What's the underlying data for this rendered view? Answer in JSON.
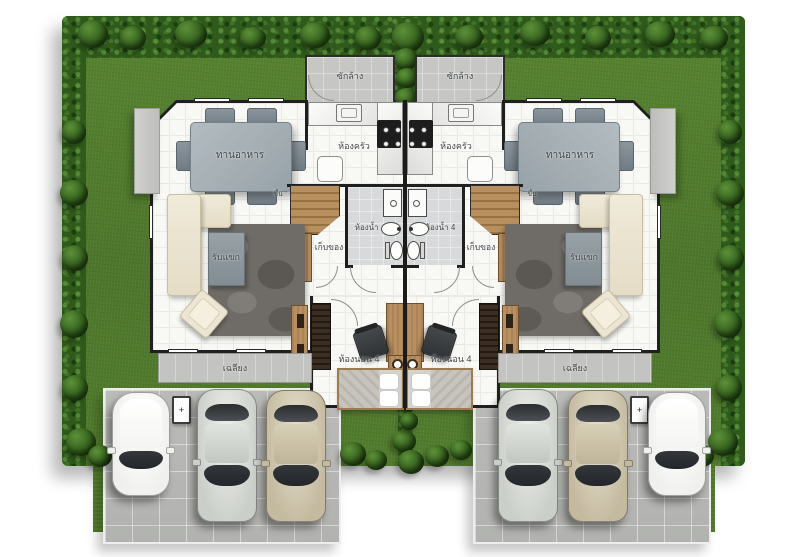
{
  "title": "Duplex twin-house floor plan, top view",
  "labels": {
    "laundry": "ซักล้าง",
    "kitchen": "ห้องครัว",
    "dining": "ทานอาหาร",
    "living": "รับแขก",
    "bathroom": "ห้องน้ำ 4",
    "storage": "เก็บของ",
    "bedroom": "ห้องนอน 4",
    "terrace": "เฉลียง",
    "stairs": "ขึ้น",
    "meter": "+"
  },
  "units": [
    {
      "side": "left"
    },
    {
      "side": "right",
      "note": "mirror image of left unit"
    }
  ],
  "cars": [
    {
      "position": "left-outer",
      "color_name": "white",
      "body_color": "#f0f0ee",
      "type": "compact"
    },
    {
      "position": "left-middle",
      "color_name": "silver",
      "body_color": "#cbcfc9",
      "type": "sedan"
    },
    {
      "position": "left-inner",
      "color_name": "beige",
      "body_color": "#c4baa0",
      "type": "sedan"
    },
    {
      "position": "right-inner",
      "color_name": "silver",
      "body_color": "#cbcfc9",
      "type": "sedan"
    },
    {
      "position": "right-middle",
      "color_name": "beige",
      "body_color": "#c4baa0",
      "type": "sedan"
    },
    {
      "position": "right-outer",
      "color_name": "white",
      "body_color": "#f0f0ee",
      "type": "compact"
    }
  ],
  "colors": {
    "grass": "#4f7c2b",
    "hedge": "#2f5a1c",
    "driveway": "#b5b6b3",
    "wall": "#1f1f1f",
    "floor": "#f8f8f5",
    "terrace": "#c3c4c1",
    "wood": "#b98f5f",
    "sofa": "#ece5d2",
    "rug": "#6f6b66",
    "table": "#9aa6ab"
  }
}
